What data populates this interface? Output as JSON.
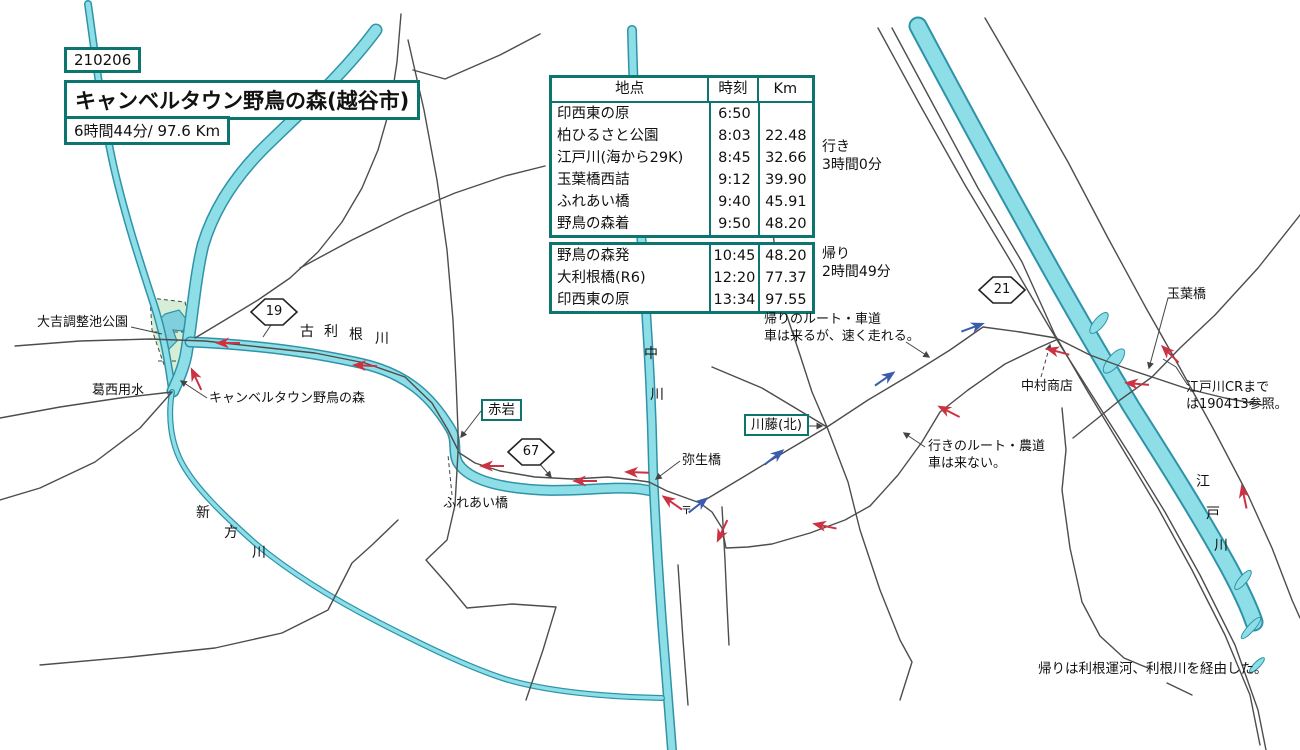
{
  "header": {
    "date_code": "210206",
    "title": "キャンベルタウン野鳥の森(越谷市)",
    "total_time_distance": "6時間44分/ 97.6 Km"
  },
  "table": {
    "columns": {
      "place": "地点",
      "time": "時刻",
      "km": "Km"
    },
    "outbound_rows": [
      {
        "name": "印西東の原",
        "time": "6:50",
        "km": ""
      },
      {
        "name": "柏ひるさと公園",
        "time": "8:03",
        "km": "22.48"
      },
      {
        "name": "江戸川(海から29K)",
        "time": "8:45",
        "km": "32.66"
      },
      {
        "name": "玉葉橋西詰",
        "time": "9:12",
        "km": "39.90"
      },
      {
        "name": "ふれあい橋",
        "time": "9:40",
        "km": "45.91"
      },
      {
        "name": "野鳥の森着",
        "time": "9:50",
        "km": "48.20"
      }
    ],
    "return_rows": [
      {
        "name": "野鳥の森発",
        "time": "10:45",
        "km": "48.20"
      },
      {
        "name": "大利根橋(R6)",
        "time": "12:20",
        "km": "77.37"
      },
      {
        "name": "印西東の原",
        "time": "13:34",
        "km": "97.55"
      }
    ],
    "outbound_note_line1": "行き",
    "outbound_note_line2": "3時間0分",
    "return_note_line1": "帰り",
    "return_note_line2": "2時間49分"
  },
  "badges": {
    "route19": "19",
    "route67": "67",
    "route21": "21"
  },
  "boxed_labels": {
    "akaiwa": "赤岩",
    "kawafuji_kita": "川藤(北)"
  },
  "labels": {
    "daikichi_park": "大吉調整池公園",
    "kasai_yosui": "葛西用水",
    "campbelltown": "キャンベルタウン野鳥の森",
    "furutone_river": "古利根川",
    "shinkata_river": "新方川",
    "naka_river": "中川",
    "edo_river": "江戸川",
    "fureai_bridge": "ふれあい橋",
    "yayoi_bridge": "弥生橋",
    "post_office_mark": "〒",
    "return_route_note_line1": "帰りのルート・車道",
    "return_route_note_line2": "車は来るが、速く走れる。",
    "outbound_route_note_line1": "行きのルート・農道",
    "outbound_route_note_line2": "車は来ない。",
    "nakamura_shop": "中村商店",
    "tamaba_bridge": "玉葉橋",
    "edogawa_cr_note_line1": "江戸川CRまで",
    "edogawa_cr_note_line2": "は190413参照。",
    "bottom_note": "帰りは利根運河、利根川を経由した。"
  },
  "colors": {
    "frame_teal": "#0d7470",
    "river_fill": "#8edee8",
    "river_edge": "#2f93a8",
    "road": "#4d4d4d",
    "outbound_arrow_red": "#cc3342",
    "return_arrow_blue": "#3b5cad",
    "park_fill": "#d6eed6"
  }
}
